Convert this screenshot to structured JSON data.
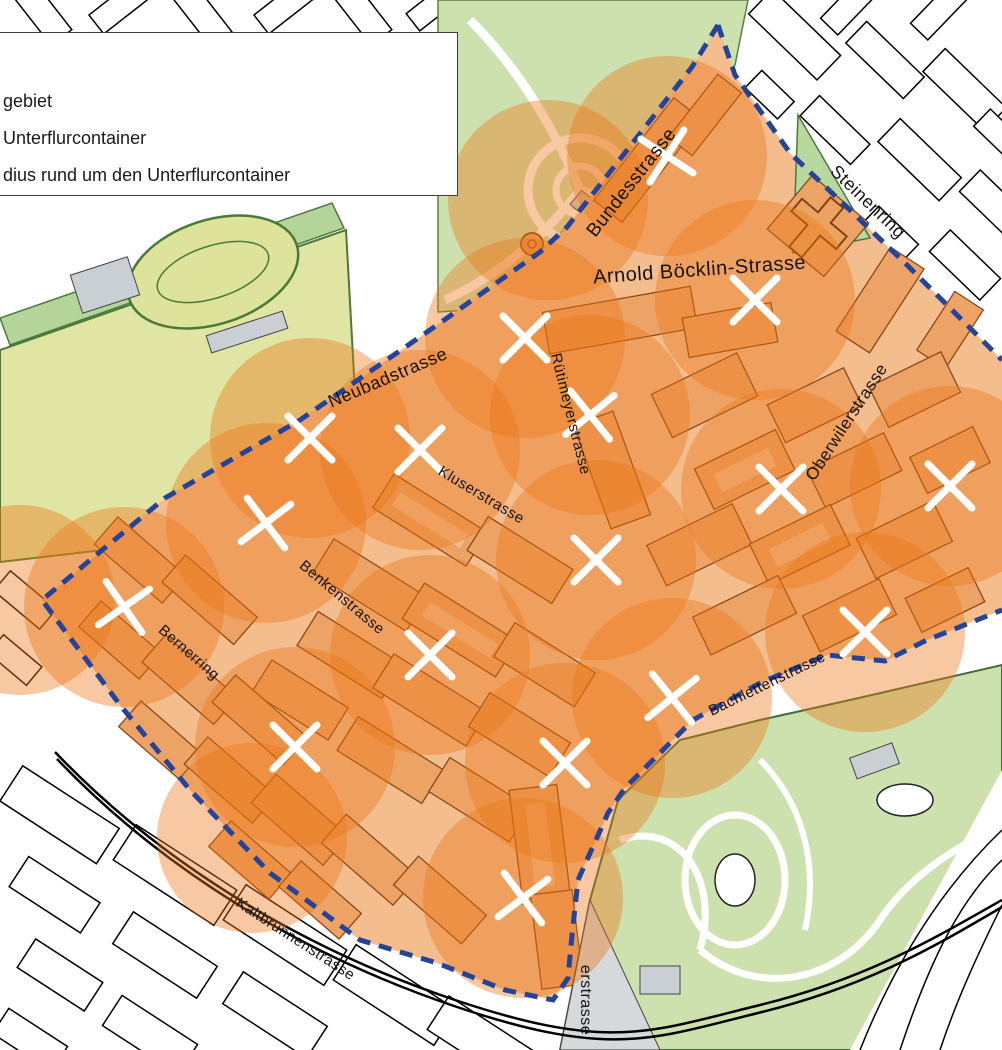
{
  "legend": {
    "items": [
      {
        "label": "gebiet"
      },
      {
        "label": "Unterflurcontainer"
      },
      {
        "label": "dius rund um den Unterflurcontainer"
      }
    ]
  },
  "colors": {
    "coverage_circle": "#ec7517",
    "coverage_opacity": "0.40",
    "boundary_blue": "#24449c",
    "marker_white": "#ffffff",
    "area_base_orange": "#f3bd8e",
    "building_orange": "#eda365",
    "building_outline": "#8a4a15",
    "park_green": "#cde1af",
    "field_green": "#e0e5a3",
    "label_black": "#141414"
  },
  "streets": [
    {
      "name": "Bundesstrasse",
      "x": 636,
      "y": 186,
      "rot": -52,
      "size": 19
    },
    {
      "name": "Steinenring",
      "x": 864,
      "y": 206,
      "rot": 44,
      "size": 18
    },
    {
      "name": "Arnold Böcklin-Strasse",
      "x": 700,
      "y": 276,
      "rot": -4,
      "size": 20
    },
    {
      "name": "Neubadstrasse",
      "x": 390,
      "y": 383,
      "rot": -23,
      "size": 18
    },
    {
      "name": "Rütimeyerstrasse",
      "x": 566,
      "y": 415,
      "rot": 76,
      "size": 15
    },
    {
      "name": "Oberwilerstrasse",
      "x": 851,
      "y": 425,
      "rot": -57,
      "size": 17
    },
    {
      "name": "Kluserstrasse",
      "x": 479,
      "y": 499,
      "rot": 31,
      "size": 15
    },
    {
      "name": "Benkenstrasse",
      "x": 339,
      "y": 601,
      "rot": 40,
      "size": 15
    },
    {
      "name": "Bernerring",
      "x": 186,
      "y": 656,
      "rot": 41,
      "size": 15
    },
    {
      "name": "Bachlettenstrasse",
      "x": 769,
      "y": 688,
      "rot": -26,
      "size": 15
    },
    {
      "name": "Kaltbrunnenstrasse",
      "x": 293,
      "y": 943,
      "rot": 33,
      "size": 15
    },
    {
      "name": "erstrasse",
      "x": 581,
      "y": 1000,
      "rot": 90,
      "size": 16
    }
  ],
  "markers": [
    {
      "x": 667,
      "y": 156,
      "rot": -12
    },
    {
      "x": 755,
      "y": 300,
      "rot": 0
    },
    {
      "x": 525,
      "y": 338,
      "rot": 0
    },
    {
      "x": 590,
      "y": 415,
      "rot": 6
    },
    {
      "x": 310,
      "y": 438,
      "rot": 0
    },
    {
      "x": 420,
      "y": 450,
      "rot": 0
    },
    {
      "x": 266,
      "y": 523,
      "rot": 8
    },
    {
      "x": 781,
      "y": 489,
      "rot": 0
    },
    {
      "x": 950,
      "y": 486,
      "rot": 0
    },
    {
      "x": 596,
      "y": 560,
      "rot": 0
    },
    {
      "x": 124,
      "y": 607,
      "rot": 10
    },
    {
      "x": 430,
      "y": 655,
      "rot": 0
    },
    {
      "x": 865,
      "y": 632,
      "rot": 0
    },
    {
      "x": 672,
      "y": 698,
      "rot": 6
    },
    {
      "x": 295,
      "y": 747,
      "rot": 0
    },
    {
      "x": 565,
      "y": 763,
      "rot": 0
    },
    {
      "x": 523,
      "y": 898,
      "rot": 8
    }
  ],
  "coverage_circles": [
    {
      "x": 667,
      "y": 156,
      "r": 100
    },
    {
      "x": 755,
      "y": 300,
      "r": 100
    },
    {
      "x": 525,
      "y": 338,
      "r": 100
    },
    {
      "x": 590,
      "y": 415,
      "r": 100
    },
    {
      "x": 310,
      "y": 438,
      "r": 100
    },
    {
      "x": 420,
      "y": 450,
      "r": 100
    },
    {
      "x": 266,
      "y": 523,
      "r": 100
    },
    {
      "x": 781,
      "y": 489,
      "r": 100
    },
    {
      "x": 950,
      "y": 486,
      "r": 100
    },
    {
      "x": 596,
      "y": 560,
      "r": 100
    },
    {
      "x": 124,
      "y": 607,
      "r": 100
    },
    {
      "x": 430,
      "y": 655,
      "r": 100
    },
    {
      "x": 865,
      "y": 632,
      "r": 100
    },
    {
      "x": 672,
      "y": 698,
      "r": 100
    },
    {
      "x": 295,
      "y": 747,
      "r": 100
    },
    {
      "x": 565,
      "y": 763,
      "r": 100
    },
    {
      "x": 523,
      "y": 898,
      "r": 100
    },
    {
      "x": 548,
      "y": 200,
      "r": 100
    },
    {
      "x": 20,
      "y": 600,
      "r": 95
    },
    {
      "x": 252,
      "y": 838,
      "r": 95
    }
  ]
}
